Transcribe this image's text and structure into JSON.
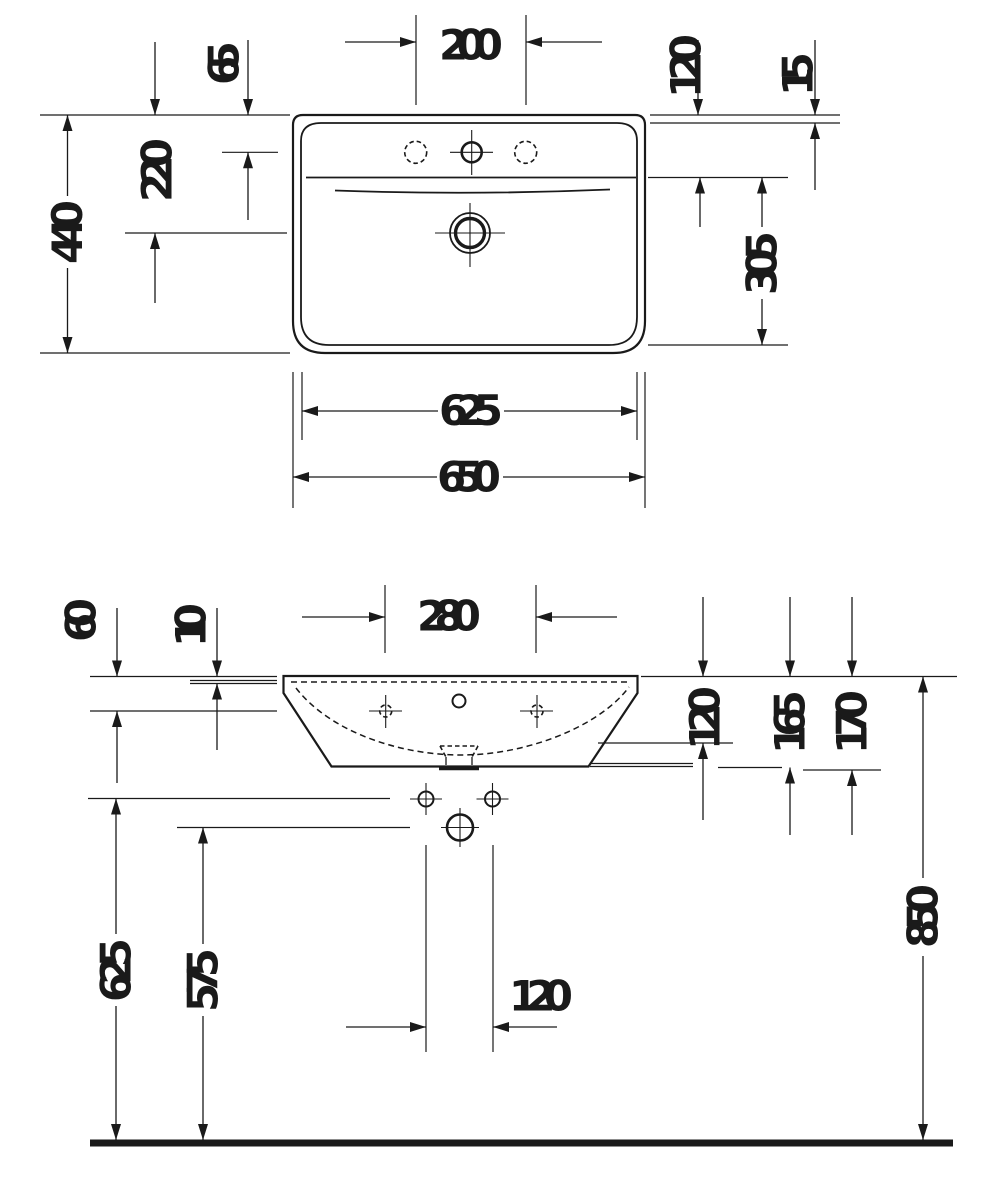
{
  "page": {
    "background": "#ffffff",
    "line_color": "#1a1a1a",
    "content": "washbasin technical dimension drawing, top view and front elevation"
  },
  "plan_view": {
    "name": "washbasin top view",
    "labels": {
      "tap_hole_spacing": "200",
      "tap_hole_offset": "65",
      "drain_center_offset": "220",
      "overall_depth": "440",
      "back_ledge_depth": "120",
      "rim_edge": "15",
      "bowl_depth": "305",
      "inner_width": "625",
      "overall_width": "650"
    }
  },
  "front_view": {
    "name": "washbasin front elevation",
    "labels": {
      "front_edge_height": "60",
      "rim_thickness": "10",
      "fixing_hole_spacing": "280",
      "basin_inner_depth": "120",
      "depth_to_flange": "165",
      "overall_body_height": "170",
      "fixing_hole_height": "625",
      "drain_height": "575",
      "bolt_hole_spacing": "120",
      "mounting_height": "850"
    }
  }
}
